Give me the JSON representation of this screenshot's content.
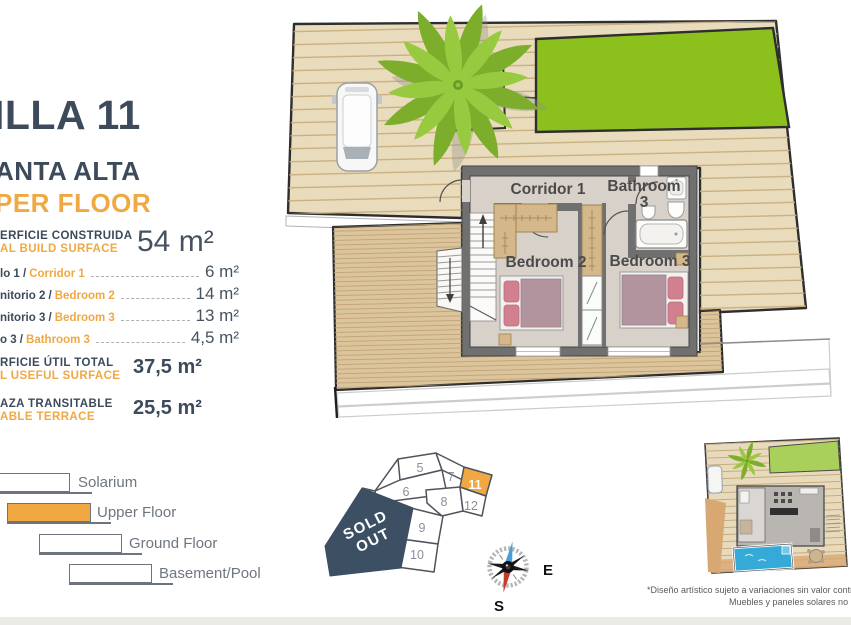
{
  "title": {
    "line1": "ILLA 11",
    "line2": "ANTA ALTA",
    "line3": "PER FLOOR"
  },
  "built": {
    "label_es": "ERFICIE CONSTRUIDA",
    "label_en": "AL BUILD SURFACE",
    "value": "54 m²"
  },
  "rooms": [
    {
      "es": "lo 1 /",
      "en": "Corridor 1",
      "value": "6 m²"
    },
    {
      "es": "nitorio 2 /",
      "en": "Bedroom 2",
      "value": "14 m²"
    },
    {
      "es": "nitorio 3 /",
      "en": "Bedroom 3",
      "value": "13 m²"
    },
    {
      "es": "o 3 /",
      "en": "Bathroom 3",
      "value": "4,5 m²"
    }
  ],
  "useful": {
    "label_es": "RFICIE ÚTIL TOTAL",
    "label_en": "L USEFUL SURFACE",
    "value": "37,5 m²"
  },
  "terrace": {
    "label_es": "AZA TRANSITABLE",
    "label_en": "ABLE TERRACE",
    "value": "25,5 m²"
  },
  "legend": {
    "items": [
      {
        "label": "Solarium"
      },
      {
        "label": "Upper Floor"
      },
      {
        "label": "Ground Floor"
      },
      {
        "label": "Basement/Pool"
      }
    ],
    "active_item": "Upper Floor"
  },
  "plan_labels": {
    "corridor": "Corridor 1",
    "bathroom_line1": "Bathroom",
    "bathroom_line2": "3",
    "bedroom2": "Bedroom 2",
    "bedroom3": "Bedroom 3"
  },
  "keyplan": {
    "plots": [
      "5",
      "7",
      "11",
      "6",
      "8",
      "12",
      "9",
      "10"
    ],
    "highlighted_plot": "11",
    "sold_line1": "SOLD",
    "sold_line2": "OUT"
  },
  "compass": {
    "east": "E",
    "south": "S"
  },
  "disclaimer": {
    "line1": "*Diseño artístico sujeto a variaciones sin valor contrac",
    "line2": "Muebles y paneles solares no inclu"
  },
  "colors": {
    "navy": "#3C4A5C",
    "orange": "#F0A843",
    "lawn_green": "#8CC11D",
    "deck_tan": "#E9DCBD",
    "terrace_tan": "#DCC59C",
    "pool_blue": "#35A9D7",
    "sold_navy": "#3D4F63",
    "bed_mauve": "#B2949F"
  }
}
